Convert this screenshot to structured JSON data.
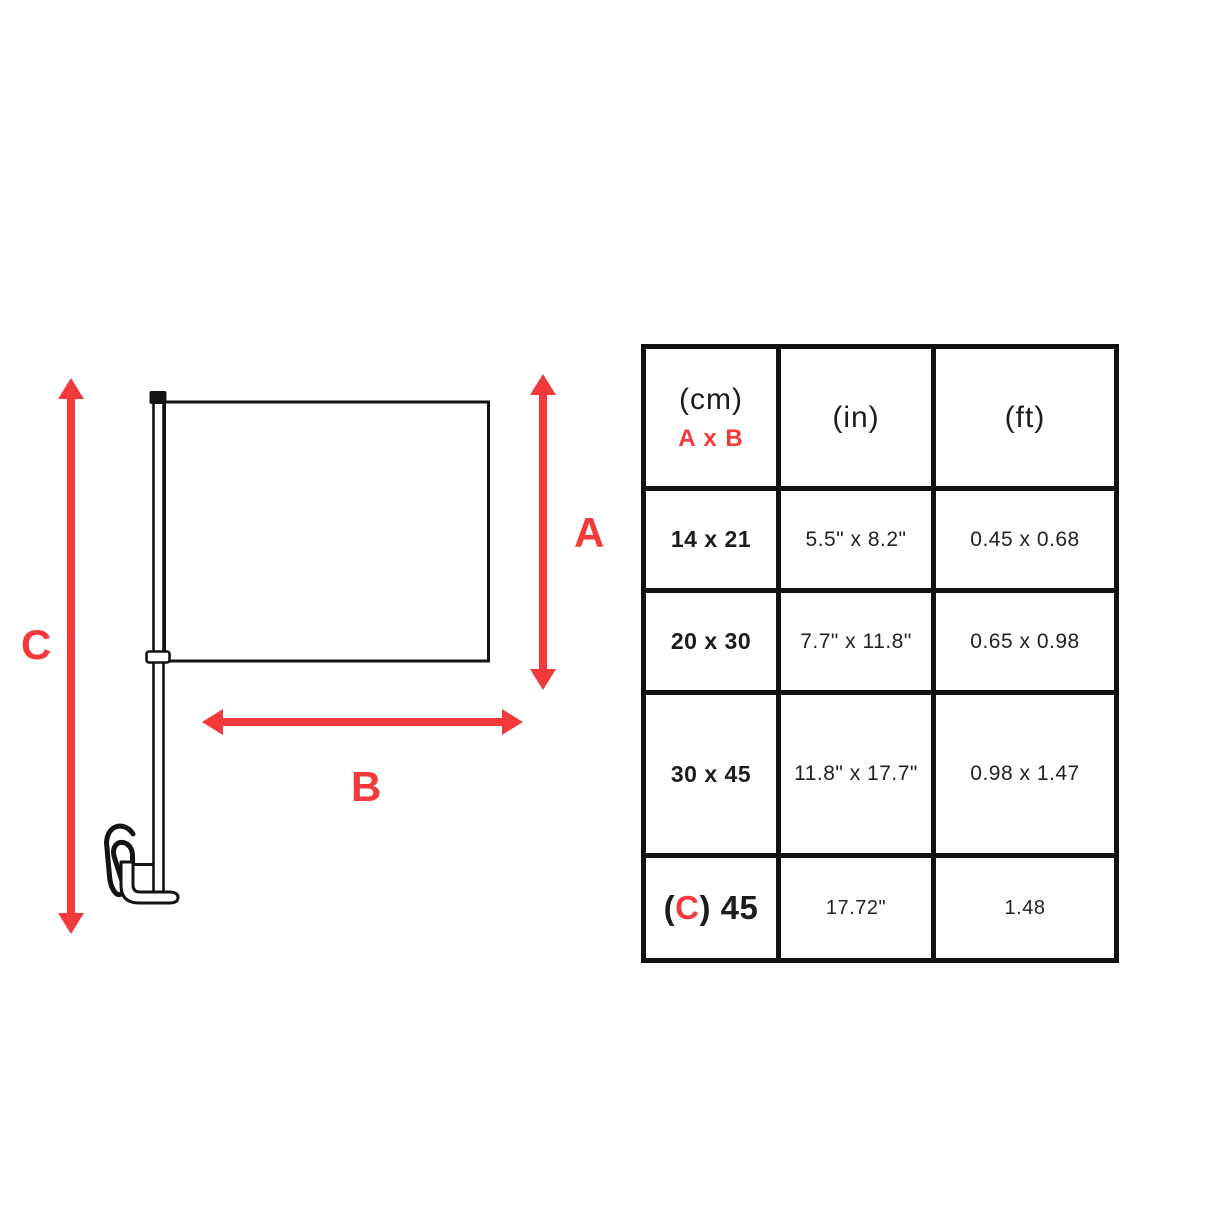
{
  "colors": {
    "accent_red": "#F4393B",
    "line_black": "#111111",
    "background": "#ffffff"
  },
  "diagram": {
    "description": "car-flag-with-pole-and-window-clip",
    "labels": {
      "a": "A",
      "b": "B",
      "c": "C"
    }
  },
  "table": {
    "header": {
      "cm_unit": "(cm)",
      "cm_sub": "A x B",
      "in_unit": "(in)",
      "ft_unit": "(ft)"
    },
    "rows": [
      {
        "cm": "14 x 21",
        "in": "5.5\" x 8.2\"",
        "ft": "0.45 x 0.68"
      },
      {
        "cm": "20 x 30",
        "in": "7.7\" x 11.8\"",
        "ft": "0.65 x 0.98"
      },
      {
        "cm": "30 x 45",
        "in": "11.8\" x 17.7\"",
        "ft": "0.98 x 1.47"
      },
      {
        "cm_pre": "(",
        "cm_c": "C",
        "cm_post": ") 45",
        "in": "17.72\"",
        "ft": "1.48"
      }
    ]
  }
}
